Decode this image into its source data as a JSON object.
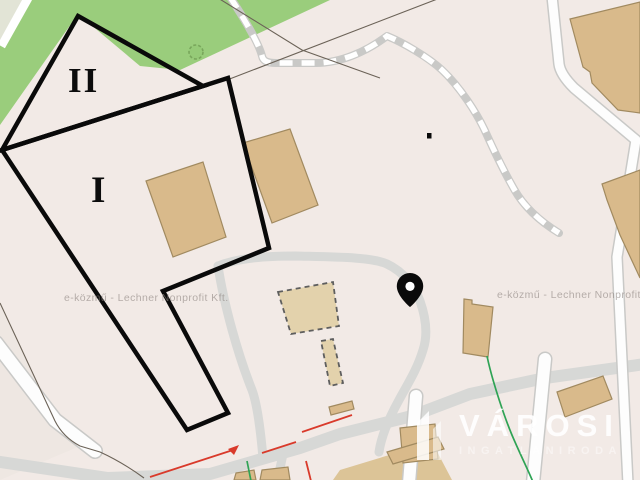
{
  "map": {
    "watermark": "e-közmű - Lechner Nonprofit Kft.",
    "zones": {
      "primary": "I",
      "secondary": "II"
    },
    "logo": {
      "title": "VÁROSI",
      "subtitle": "INGATLANIRODA"
    },
    "icons": [
      "location-pin-icon",
      "tree-icon",
      "brand-building-icon"
    ],
    "colors": {
      "background": "#f2eae6",
      "green_area": "#9acd7c",
      "green_corner": "#e2e4d6",
      "building_fill": "#d9ba8b",
      "building_stroke": "#a18a60",
      "building_dashed_fill": "#e3d2ac",
      "tan_zone": "#dcc497",
      "road_gray": "#d7d8d6",
      "road_white": "#fdfdfd",
      "cadastre_line": "#6b6257",
      "outline_black": "#0a0a0a",
      "utility_red": "#d93a2b",
      "utility_green": "#2fa355",
      "watermark_gray": "#8f8682",
      "logo_white": "#ffffff"
    }
  }
}
